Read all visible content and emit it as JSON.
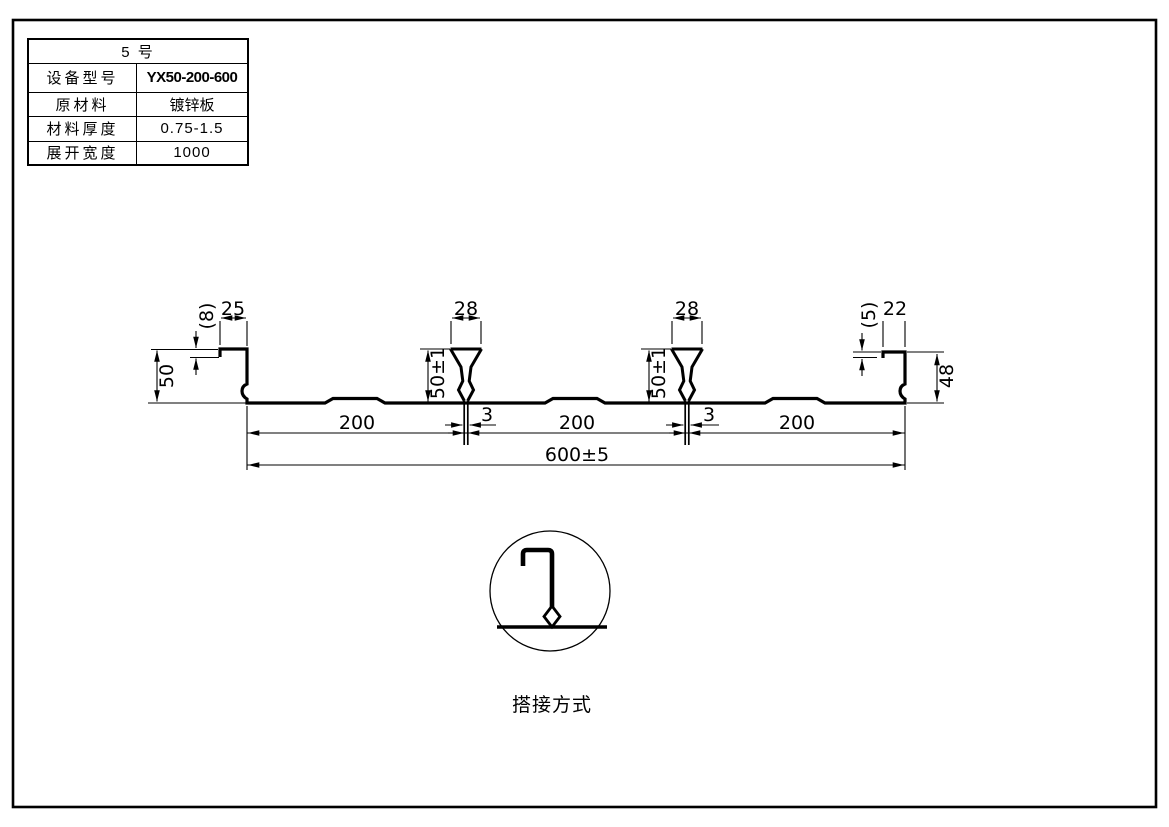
{
  "table": {
    "header": "5  号",
    "rows": [
      {
        "label": "设备型号",
        "value": "YX50-200-600"
      },
      {
        "label": "原材料",
        "value": "镀锌板"
      },
      {
        "label": "材料厚度",
        "value": "0.75-1.5"
      },
      {
        "label": "展开宽度",
        "value": "1000"
      }
    ]
  },
  "dims": {
    "left_lip": "(8)",
    "left_top_flange": "25",
    "left_height": "50",
    "rib1_top": "28",
    "rib1_height": "50±1",
    "rib1_gap": "3",
    "rib2_top": "28",
    "rib2_height": "50±1",
    "rib2_gap": "3",
    "pitch1": "200",
    "pitch2": "200",
    "pitch3": "200",
    "overall": "600±5",
    "right_lip": "(5)",
    "right_top_flange": "22",
    "right_height": "48"
  },
  "detail": {
    "caption": "搭接方式"
  },
  "colors": {
    "line": "#000000",
    "background": "#ffffff"
  }
}
